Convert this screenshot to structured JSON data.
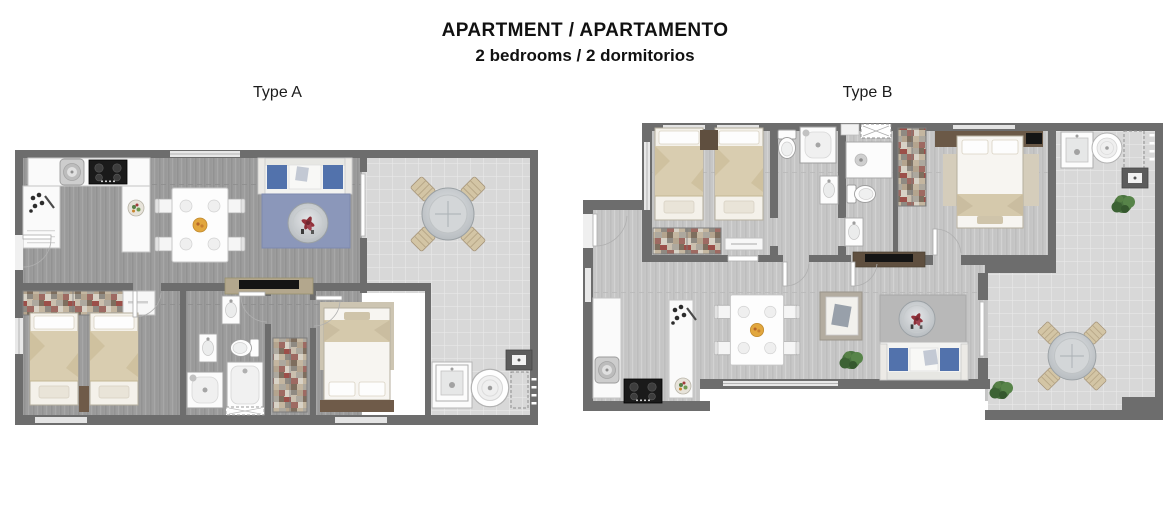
{
  "header": {
    "title": "APARTMENT / APARTAMENTO",
    "subtitle": "2 bedrooms / 2 dormitorios"
  },
  "plans": [
    {
      "label": "Type A",
      "features": [
        "kitchen with stove and fridge",
        "dining table with 4 chairs",
        "sofa with blue cushions and round coffee table",
        "tiled balcony with round table and 4 chairs",
        "bedroom with 2 single beds and wardrobe",
        "bathroom with toilet, sinks, shower and tub",
        "master bedroom with double bed",
        "laundry terrace with sink, washer and reserved space"
      ]
    },
    {
      "label": "Type B",
      "features": [
        "bedroom with 2 single beds and wardrobe",
        "two bathrooms with toilet, shower and sinks",
        "master bedroom with double bed and TV shelf",
        "laundry terrace with sink, washer and plant",
        "kitchen with stove and fridge",
        "dining table with 4 chairs",
        "living area with sofa, armchair and round coffee table",
        "tiled terrace with round table, 4 chairs and plants"
      ]
    }
  ],
  "colors": {
    "wall": "#6d6d6d",
    "floor_type_a": "#9d9d9d",
    "floor_type_b": "#c6c6c6",
    "balcony_tile": "#d8d8d8",
    "furniture_white": "#f5f5f5",
    "bed_blanket_beige": "#d9cdb0",
    "sofa_cushion_blue": "#5272ac",
    "rug_blue": "#8b97ba",
    "rug_beige": "#cdc5b2",
    "wood_brown": "#6f5b49",
    "plant_green": "#4a7340",
    "flower_red": "#93323c",
    "stove_black": "#1a1a1a"
  }
}
